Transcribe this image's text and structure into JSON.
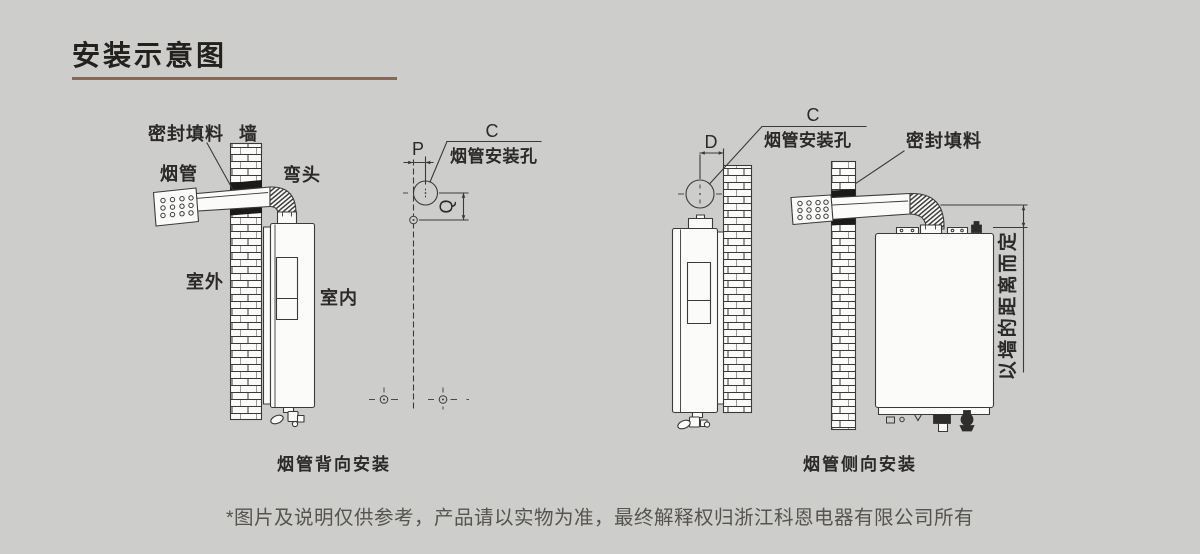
{
  "page": {
    "title": "安装示意图",
    "footnote": "*图片及说明仅供参考，产品请以实物为准，最终解释权归浙江科恩电器有限公司所有",
    "colors": {
      "background": "#cdcdcb",
      "line": "#3a3a38",
      "title_underline": "#8a6753",
      "seal_fill": "#1b1a18",
      "text": "#2b2a28",
      "footnote_text": "#56544f"
    }
  },
  "diagram_back": {
    "caption": "烟管背向安装",
    "labels": {
      "seal": "密封填料",
      "wall": "墙",
      "flue": "烟管",
      "elbow": "弯头",
      "outdoor": "室外",
      "indoor": "室内"
    },
    "template": {
      "dim_c": "C",
      "dim_p": "P",
      "dim_q": "Q",
      "hole_label": "烟管安装孔"
    }
  },
  "diagram_side": {
    "caption": "烟管侧向安装",
    "labels": {
      "dim_d": "D",
      "dim_c": "C",
      "hole_label": "烟管安装孔",
      "seal": "密封填料",
      "distance_note": "以墙的距离而定"
    }
  }
}
